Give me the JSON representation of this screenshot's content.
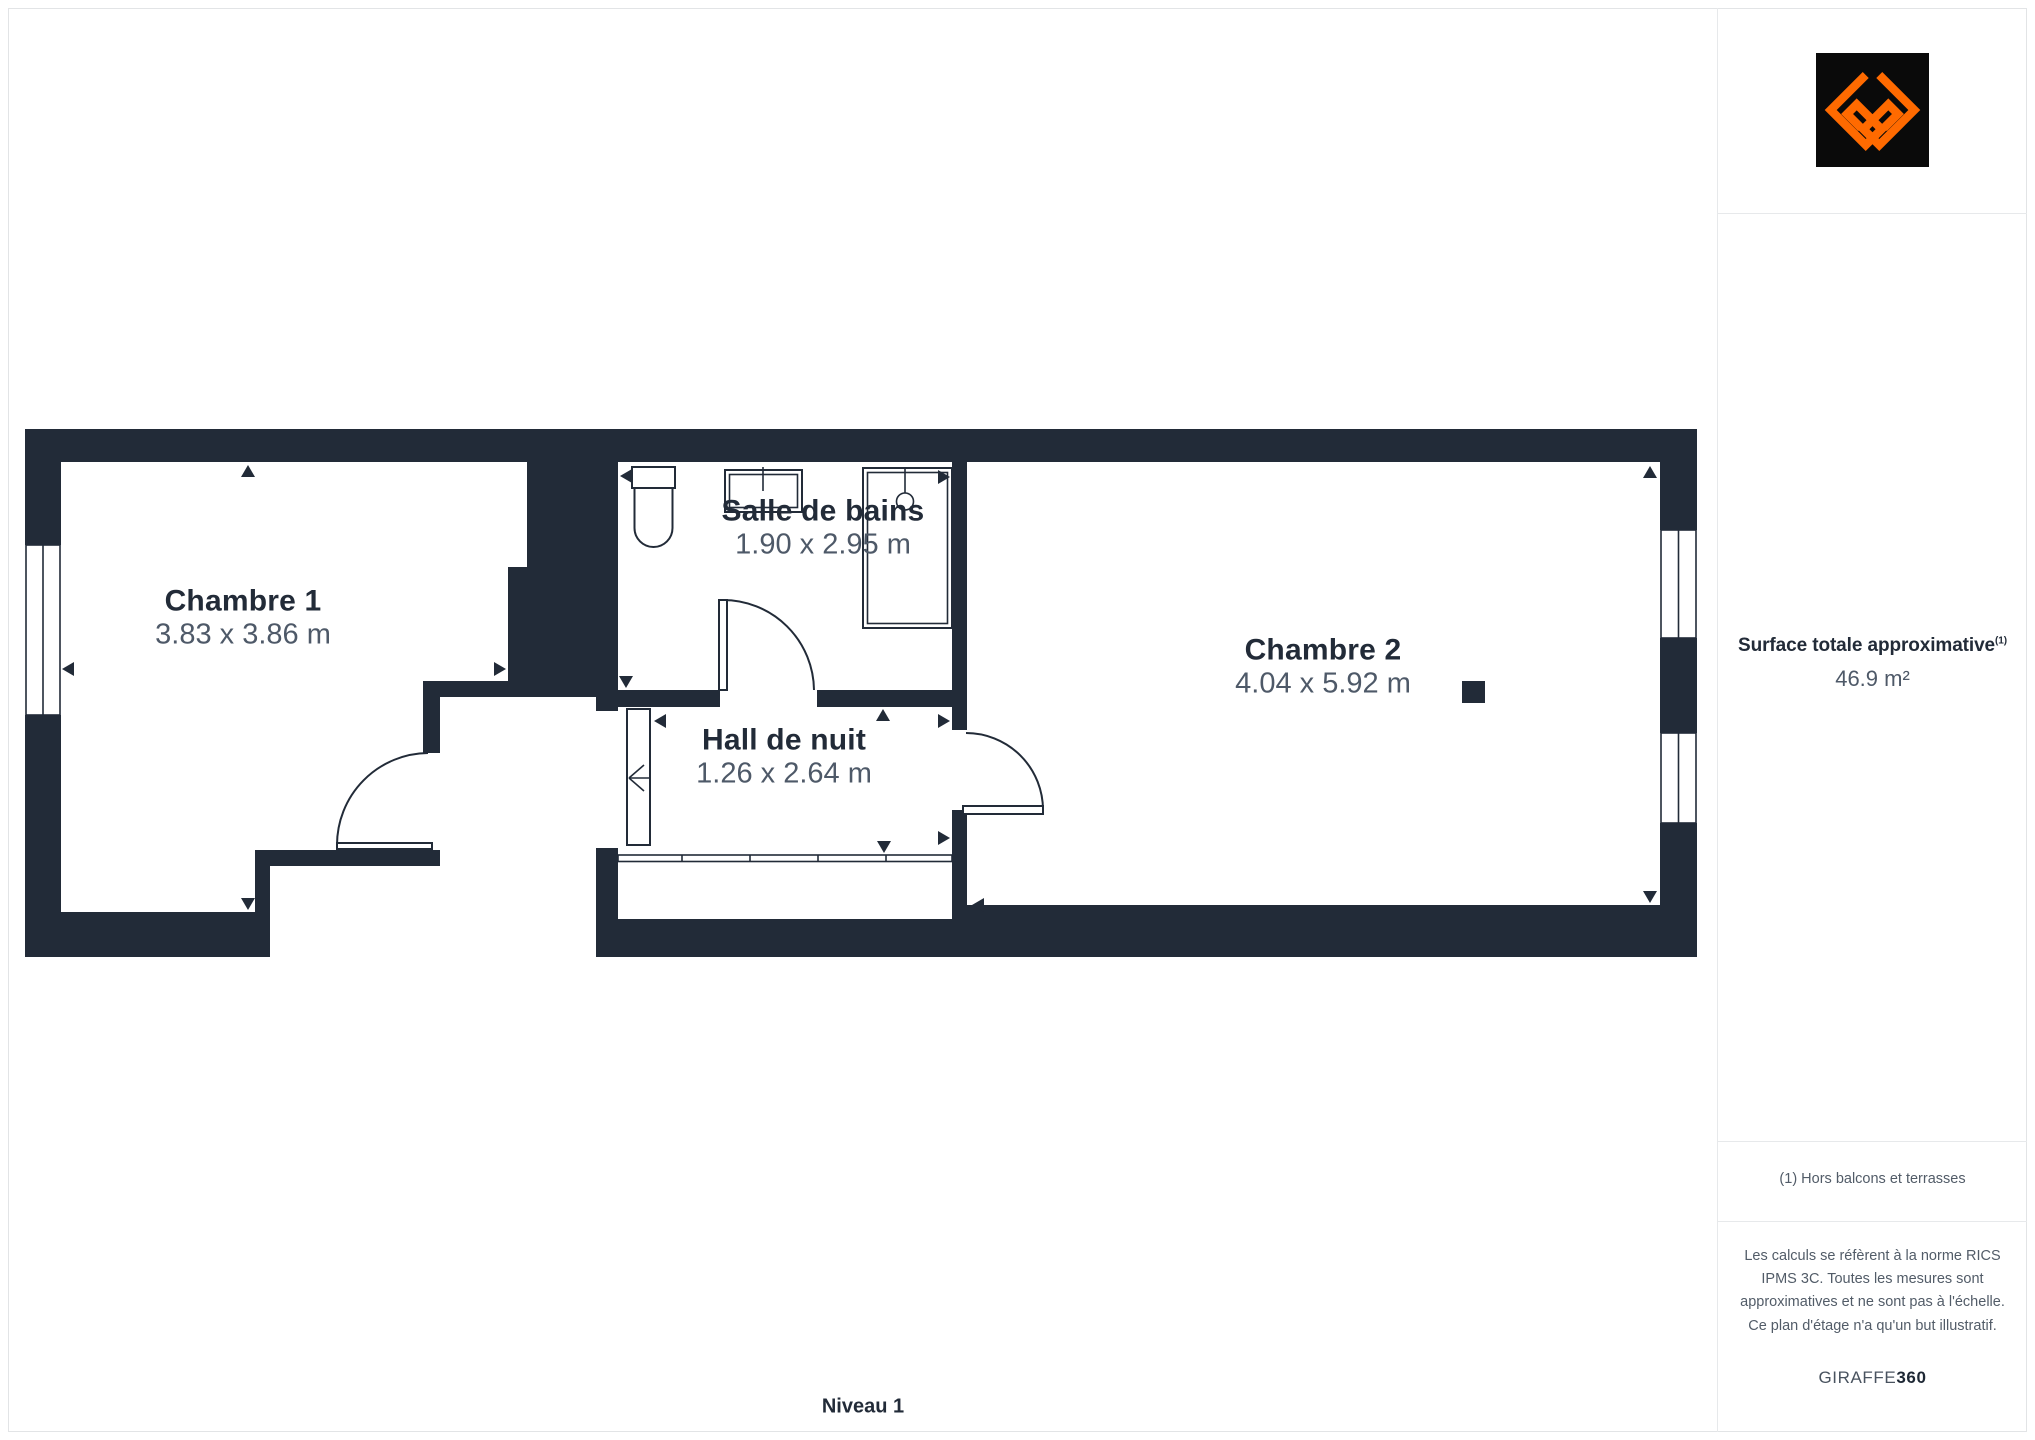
{
  "page": {
    "floor_label": "Niveau 1"
  },
  "rooms": [
    {
      "name": "Chambre 1",
      "dims": "3.83 x 3.86 m"
    },
    {
      "name": "Salle de bains",
      "dims": "1.90 x 2.95 m"
    },
    {
      "name": "Hall de nuit",
      "dims": "1.26 x 2.64 m"
    },
    {
      "name": "Chambre 2",
      "dims": "4.04 x 5.92 m"
    }
  ],
  "sidebar": {
    "surface_label": "Surface totale approximative",
    "surface_sup": "(1)",
    "surface_value": "46.9 m²",
    "note": "(1) Hors balcons et terrasses",
    "disclaimer": "Les calculs se réfèrent à la norme RICS IPMS 3C. Toutes les mesures sont approximatives et ne sont pas à l'échelle. Ce plan d'étage n'a qu'un but illustratif.",
    "brand_name": "GIRAFFE",
    "brand_suffix": "360"
  },
  "icons": {
    "logo": "giraffe360-logo-icon",
    "fixtures": [
      "toilet-icon",
      "sink-icon",
      "shower-icon"
    ],
    "symbols": [
      "window-symbol",
      "door-swing-arc",
      "dimension-arrow",
      "stair-edge",
      "column-marker"
    ]
  },
  "colors": {
    "wall": "#222B38",
    "dim": "#4E5968",
    "muted": "#525C68",
    "accent": "#FF6A00",
    "divider": "#e7e9eb",
    "frame": "#e2e4e6"
  }
}
